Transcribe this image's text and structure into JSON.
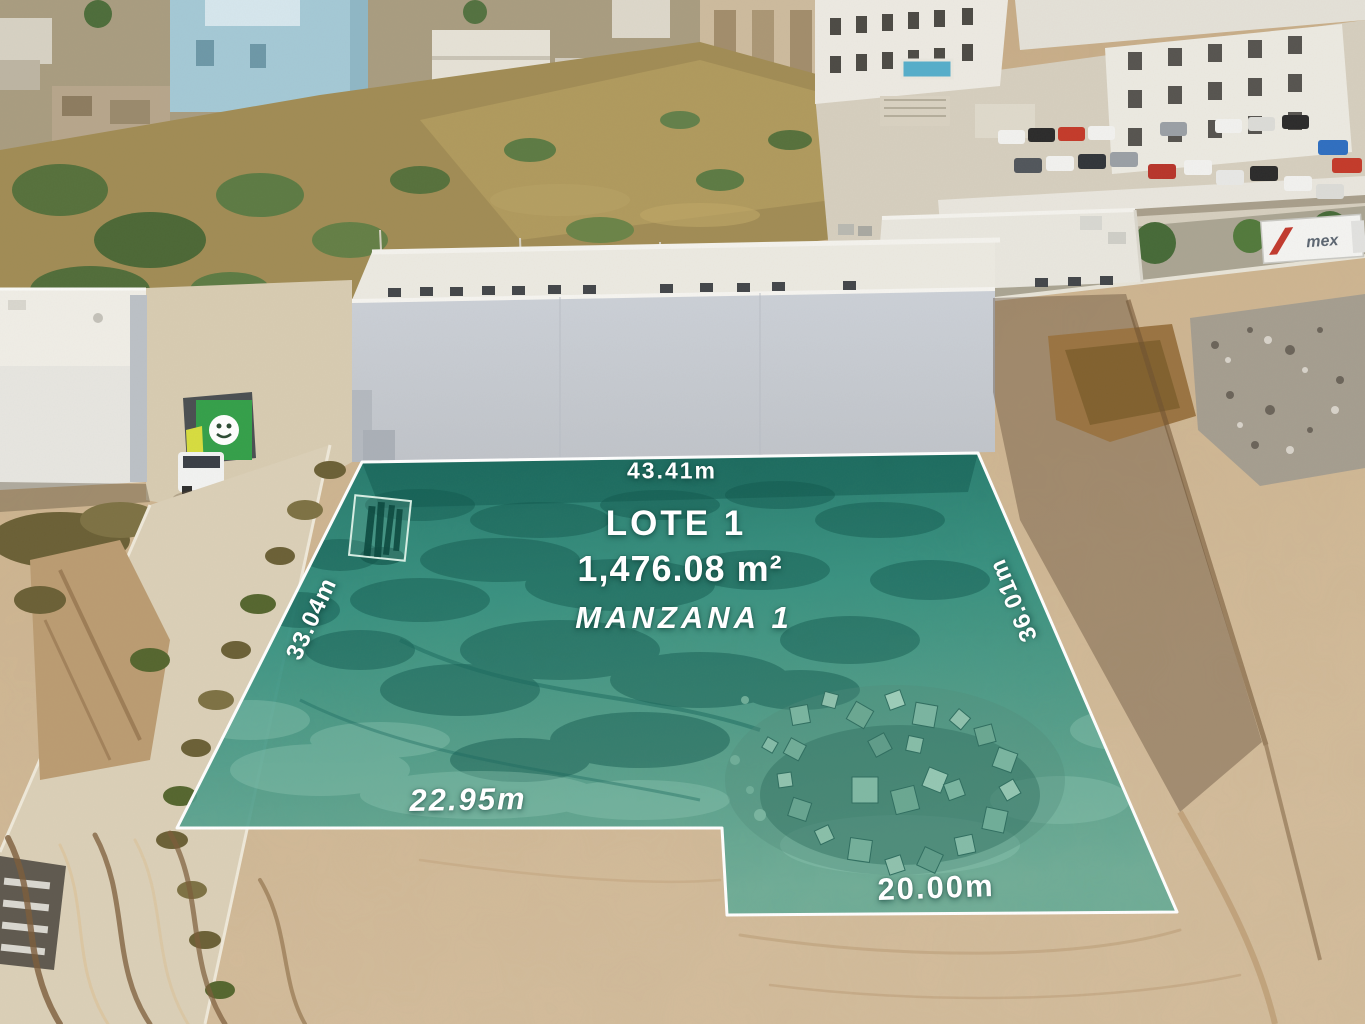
{
  "overlay": {
    "lot_title": "LOTE 1",
    "lot_area": "1,476.08 m²",
    "block": "MANZANA 1",
    "dim_top": "43.41m",
    "dim_left": "33.04m",
    "dim_right": "36.01m",
    "dim_bottom_left": "22.95m",
    "dim_bottom_right": "20.00m",
    "overlay_fill": "#2E8E7E",
    "border_color": "#FFFFFF",
    "label_color": "#FFFFFF"
  },
  "scene": {
    "truck_label": "mex"
  }
}
